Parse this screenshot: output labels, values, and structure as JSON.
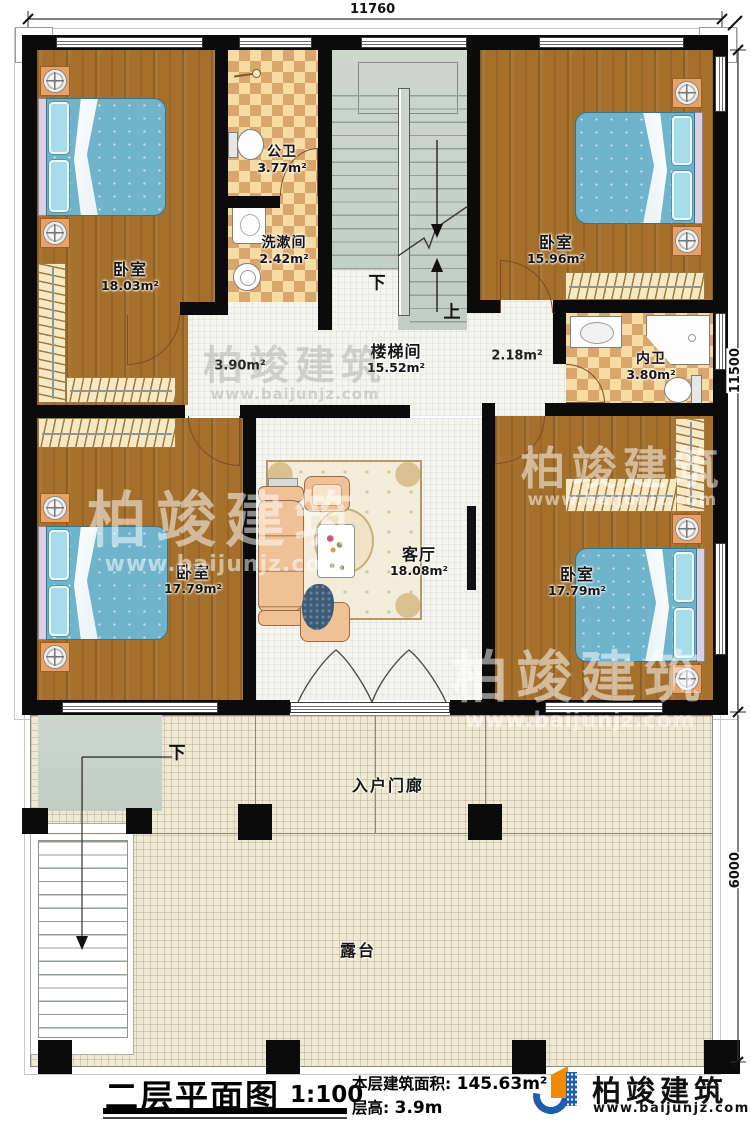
{
  "dims": {
    "top": "11760",
    "right_upper": "11500",
    "right_lower": "6000"
  },
  "rooms": {
    "bedroom_tl": {
      "name": "卧室",
      "area": "18.03m²"
    },
    "bath_public": {
      "name": "公卫",
      "area": "3.77m²"
    },
    "washroom": {
      "name": "洗漱间",
      "area": "2.42m²"
    },
    "stairwell": {
      "name": "楼梯间",
      "area": "15.52m²"
    },
    "bedroom_tr": {
      "name": "卧室",
      "area": "15.96m²"
    },
    "bath_inner": {
      "name": "内卫",
      "area": "3.80m²"
    },
    "living": {
      "name": "客厅",
      "area": "18.08m²"
    },
    "bedroom_bl": {
      "name": "卧室",
      "area": "17.79m²"
    },
    "bedroom_br": {
      "name": "卧室",
      "area": "17.79m²"
    },
    "porch": {
      "name": "入户门廊"
    },
    "terrace": {
      "name": "露台"
    }
  },
  "hall": {
    "left_area": "3.90m²",
    "right_area": "2.18m²"
  },
  "stairs": {
    "down": "下",
    "up": "上",
    "terrace_down": "下"
  },
  "watermark": {
    "brand": "柏竣建筑",
    "url": "www.baijunjz.com"
  },
  "titleblock": {
    "title": "二层平面图",
    "scale": "1:100",
    "area_label": "本层建筑面积:",
    "area_value": "145.63m²",
    "floor_height_label": "层高:",
    "floor_height_value": "3.9m",
    "brand": "柏竣建筑",
    "brand_url": "www.baijunjz.com"
  },
  "colors": {
    "wall": "#0b0b0b",
    "wood": "#a4702c",
    "tile_bath": "#f6dca2",
    "terrace": "#efe9d4",
    "brand_blue": "#1e5fad",
    "brand_orange": "#f08a00"
  }
}
